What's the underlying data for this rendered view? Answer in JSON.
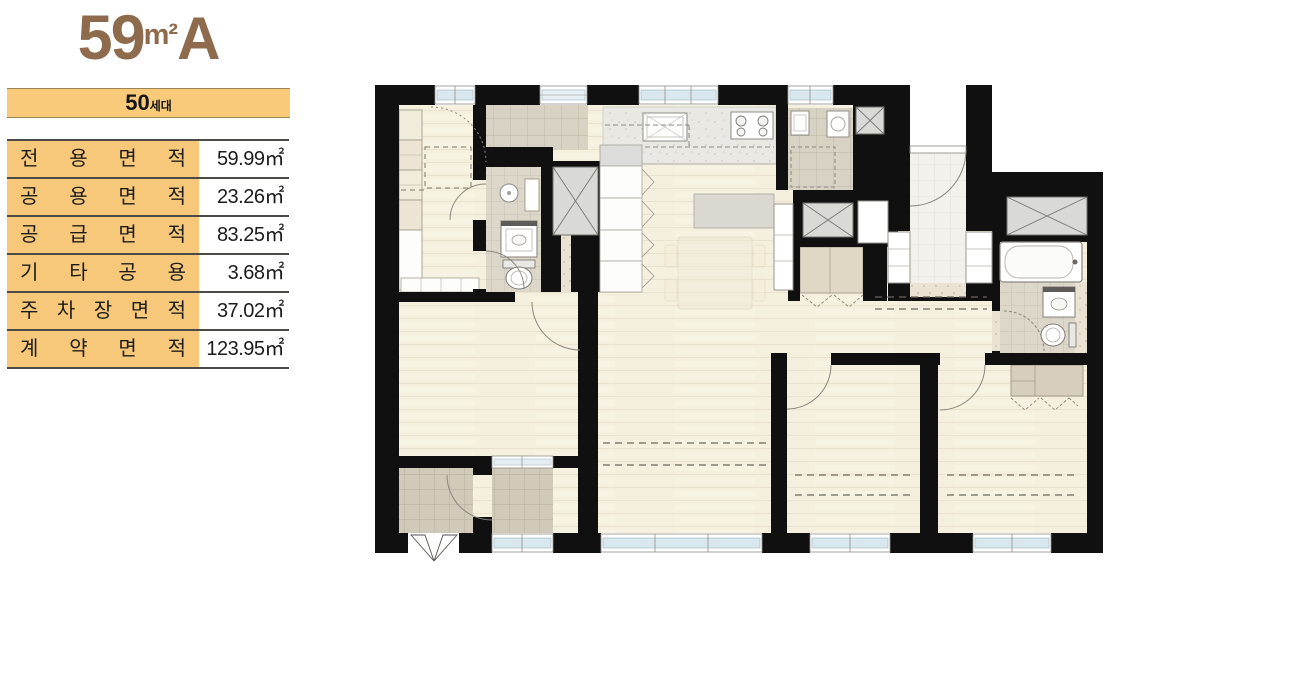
{
  "unit": {
    "number": "59",
    "unit": "m²",
    "type": "A"
  },
  "households": {
    "count": "50",
    "suffix": "세대"
  },
  "area_table": {
    "rows": [
      {
        "label": "전 용 면 적",
        "value": "59.99㎡"
      },
      {
        "label": "공 용 면 적",
        "value": "23.26㎡"
      },
      {
        "label": "공 급 면 적",
        "value": "83.25㎡"
      },
      {
        "label": "기 타 공 용",
        "value": "3.68㎡"
      },
      {
        "label": "주 차 장 면 적",
        "value": "37.02㎡"
      },
      {
        "label": "계 약 면 적",
        "value": "123.95㎡"
      }
    ]
  },
  "colors": {
    "accent_brown": "#8f6b4d",
    "band_orange": "#f8ca79",
    "table_label_orange": "#f7c87a",
    "wall_black": "#101010",
    "wood_floor": "#f5f0dd",
    "tile_gray": "#dcd7c9"
  }
}
